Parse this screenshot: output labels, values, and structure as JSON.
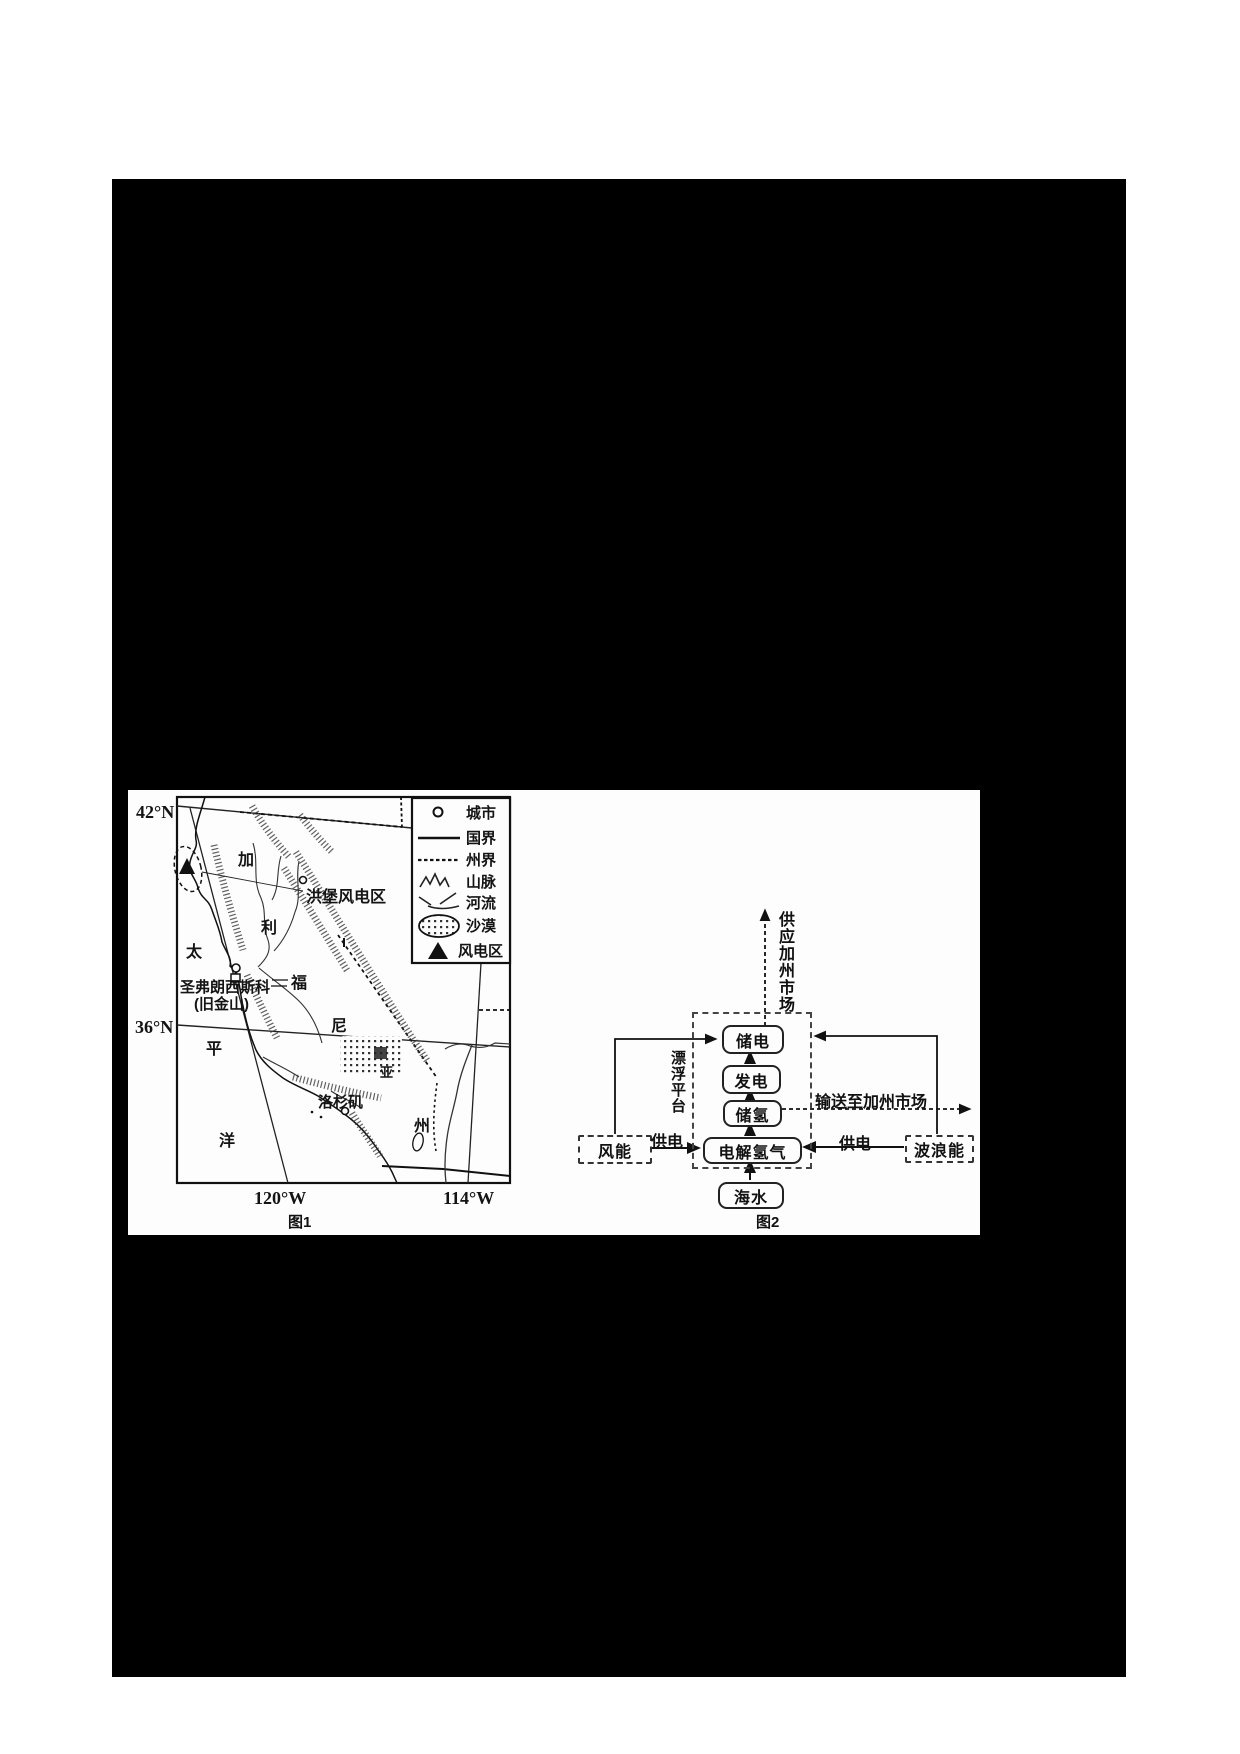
{
  "figure1": {
    "caption": "图1",
    "coords": {
      "lat_top": "42°N",
      "lat_bottom": "36°N",
      "lon_left": "120°W",
      "lon_right": "114°W"
    },
    "ocean_chars": {
      "c1": "太",
      "c2": "平",
      "c3": "洋"
    },
    "state_chars": {
      "c1": "加",
      "c2": "利",
      "c3": "福",
      "c4": "尼",
      "c5": "亚",
      "c6": "州"
    },
    "labels": {
      "wind_area": "洪堡风电区",
      "san_francisco": "圣弗朗西斯科",
      "san_francisco_alt": "(旧金山)",
      "los_angeles": "洛杉矶"
    },
    "legend": {
      "city": "城市",
      "national_border": "国界",
      "state_border": "州界",
      "mountains": "山脉",
      "river": "河流",
      "desert": "沙漠",
      "wind_zone": "风电区"
    }
  },
  "figure2": {
    "caption": "图2",
    "boxes": {
      "store_power": "储电",
      "generate_power": "发电",
      "store_hydrogen": "储氢",
      "electrolysis": "电解氢气",
      "seawater": "海水",
      "wind_energy": "风能",
      "wave_energy": "波浪能"
    },
    "flows": {
      "supply_market": "供应加州市场",
      "platform": "漂浮平台",
      "transport": "输送至加州市场",
      "supply_left": "供电",
      "supply_right": "供电"
    }
  }
}
